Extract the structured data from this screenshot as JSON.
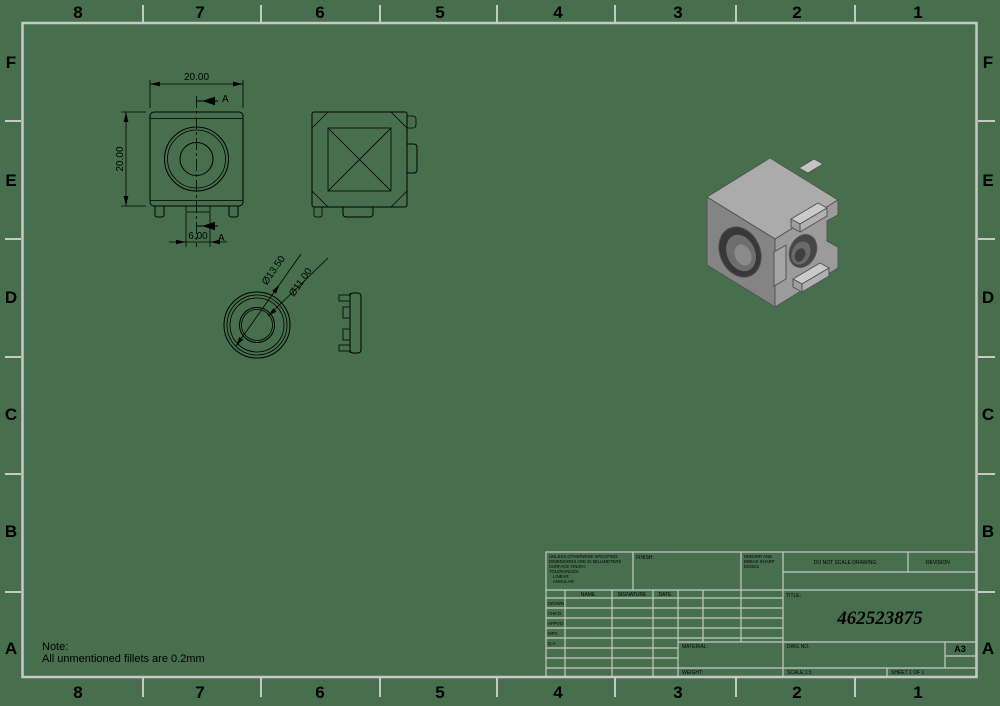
{
  "colors": {
    "background": "#476f4e",
    "format_lines": "#c6c9c5",
    "drawing_lines": "#000000"
  },
  "border": {
    "columns": [
      "8",
      "7",
      "6",
      "5",
      "4",
      "3",
      "2",
      "1"
    ],
    "rows": [
      "F",
      "E",
      "D",
      "C",
      "B",
      "A"
    ]
  },
  "note": {
    "line1": "Note:",
    "line2": "All unmentioned fillets are 0.2mm"
  },
  "dimensions": {
    "overall_width": "20.00",
    "overall_height": "20.00",
    "foot_width": "6.00",
    "section_label_top": "A",
    "section_label_bottom": "A",
    "ring_outer_dia": "Ø13.50",
    "ring_inner_dia": "Ø11.00"
  },
  "title_block": {
    "tolerance_note": [
      "UNLESS OTHERWISE SPECIFIED:",
      "DIMENSIONS ARE IN MILLIMETERS",
      "SURFACE FINISH:",
      "TOLERANCES:",
      "LINEAR:",
      "ANGULAR:"
    ],
    "finish_label": "FINISH:",
    "deburr_note": [
      "DEBURR AND",
      "BREAK SHARP",
      "EDGES"
    ],
    "do_not_scale": "DO NOT SCALE DRAWING",
    "revision_label": "REVISION",
    "columns": [
      "NAME",
      "SIGNATURE",
      "DATE"
    ],
    "approval_rows": [
      "DRAWN",
      "CHK'D",
      "APPV'D",
      "MFG",
      "Q.A"
    ],
    "title_label": "TITLE:",
    "title_value": "462523875",
    "material_label": "MATERIAL:",
    "weight_label": "WEIGHT:",
    "dwg_no_label": "DWG NO.",
    "paper_size": "A3",
    "scale_label": "SCALE:1:1",
    "sheet_label": "SHEET 1 OF 1"
  }
}
